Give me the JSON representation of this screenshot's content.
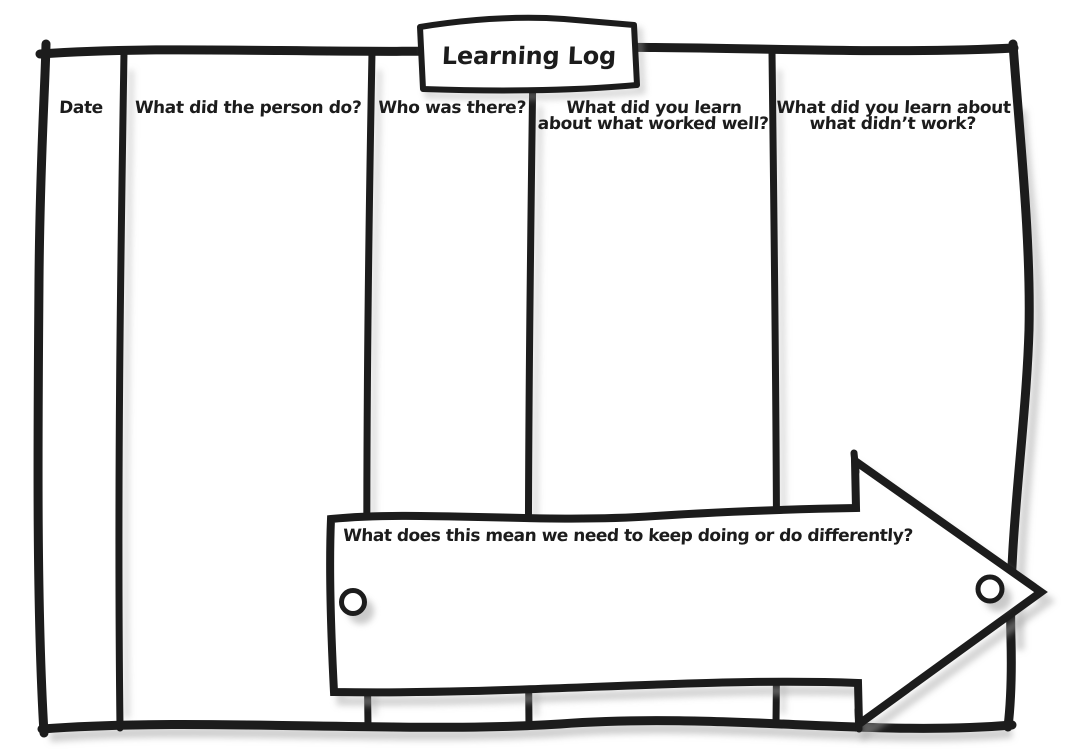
{
  "title": "Learning Log",
  "columns": [
    {
      "lines": [
        "Date"
      ]
    },
    {
      "lines": [
        "What did the person do?"
      ]
    },
    {
      "lines": [
        "Who was there?"
      ]
    },
    {
      "lines": [
        "What did you learn",
        "about what worked well?"
      ]
    },
    {
      "lines": [
        "What did you learn about",
        "what didn’t work?"
      ]
    }
  ],
  "arrow": {
    "label": "What does this mean we need to keep doing or do differently?"
  },
  "icons": {
    "left_grommet": "circle-grommet-hole",
    "right_grommet": "circle-grommet-hole"
  },
  "colors": {
    "ink": "#1c1c1c",
    "paper": "#ffffff",
    "shadow": "#a6a6a6"
  }
}
